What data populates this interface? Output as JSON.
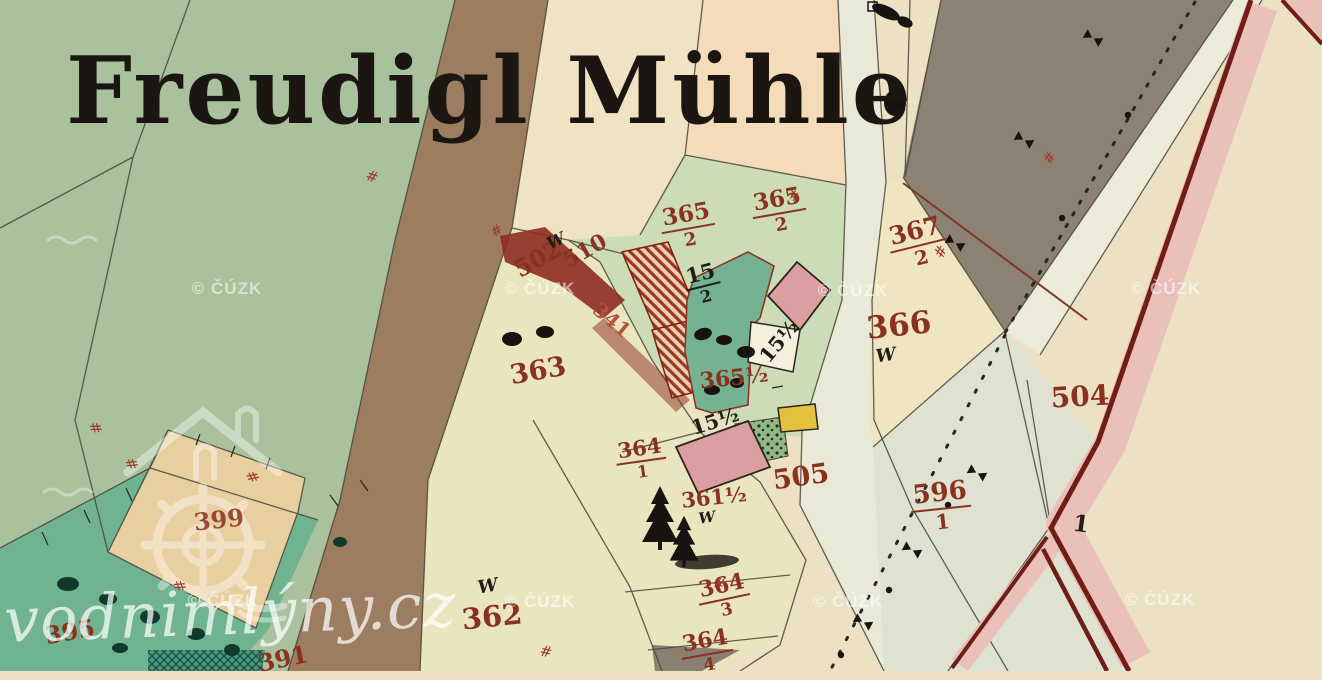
{
  "map": {
    "title": "Freudigl Mühle",
    "watermark": {
      "copyright": "© ČÚZK",
      "site": "vodnimlýny.cz",
      "copyright_positions": [
        {
          "x": 227,
          "y": 289
        },
        {
          "x": 540,
          "y": 289
        },
        {
          "x": 853,
          "y": 291
        },
        {
          "x": 1166,
          "y": 289
        },
        {
          "x": 223,
          "y": 601
        },
        {
          "x": 540,
          "y": 602
        },
        {
          "x": 848,
          "y": 602
        },
        {
          "x": 1160,
          "y": 600
        }
      ]
    },
    "palette": {
      "paper_cream": "#ece1c2",
      "meadow_green": "#a9c19d",
      "garden_teal": "#74b292",
      "garden_teal_low": "#6fb390",
      "road_brown": "#9c7d60",
      "road_pale": "#e9e9d7",
      "pale_area": "#dfe2d1",
      "gray_parcel": "#8d8173",
      "peach": "#f4dcba",
      "light_green": "#ccdcb6",
      "khaki": "#e9e6bf",
      "tan_diamond": "#e8cf9f",
      "pink_building": "#db9fa2",
      "building_hatch_red": "#9e3424",
      "channel_carmine": "#8e2c20",
      "yellow_structure": "#e5c23d",
      "boundary_line": "#4a443b",
      "red_border_line": "#6f1d15",
      "pink_band": "#eac1ba",
      "label_red": "#8a3120",
      "label_black": "#201c17"
    },
    "labels": [
      {
        "name": "parcel-365-2-a",
        "num": "365",
        "den": "2",
        "x": 688,
        "y": 226,
        "rot": -10,
        "size": 23,
        "cls": "red"
      },
      {
        "name": "parcel-365-2-b",
        "num": "365",
        "den": "2",
        "x": 779,
        "y": 211,
        "rot": -10,
        "size": 23,
        "cls": "red"
      },
      {
        "name": "parcel-367-2",
        "num": "367",
        "den": "2",
        "x": 918,
        "y": 243,
        "rot": -14,
        "size": 25,
        "cls": "red"
      },
      {
        "name": "parcel-366",
        "text": "366",
        "x": 899,
        "y": 326,
        "rot": -6,
        "size": 31,
        "cls": "red"
      },
      {
        "name": "parcel-363",
        "text": "363",
        "x": 538,
        "y": 371,
        "rot": -10,
        "size": 27,
        "cls": "red"
      },
      {
        "name": "parcel-362",
        "text": "362",
        "x": 492,
        "y": 617,
        "rot": -6,
        "size": 29,
        "cls": "red"
      },
      {
        "name": "parcel-364-1",
        "num": "364",
        "den": "1",
        "x": 641,
        "y": 459,
        "rot": -8,
        "size": 21,
        "cls": "red"
      },
      {
        "name": "parcel-361-half",
        "text": "361½",
        "x": 714,
        "y": 497,
        "rot": -6,
        "size": 21,
        "cls": "red"
      },
      {
        "name": "parcel-364-3",
        "num": "364",
        "den": "3",
        "x": 724,
        "y": 597,
        "rot": -12,
        "size": 22,
        "cls": "red"
      },
      {
        "name": "parcel-364-4",
        "num": "364",
        "den": "4",
        "x": 707,
        "y": 652,
        "rot": -10,
        "size": 22,
        "cls": "red"
      },
      {
        "name": "parcel-505",
        "text": "505",
        "x": 801,
        "y": 477,
        "rot": -8,
        "size": 27,
        "cls": "red"
      },
      {
        "name": "parcel-504",
        "text": "504",
        "x": 1080,
        "y": 397,
        "rot": -3,
        "size": 28,
        "cls": "red"
      },
      {
        "name": "parcel-596-1",
        "num": "596",
        "den": "1",
        "x": 941,
        "y": 506,
        "rot": -6,
        "size": 26,
        "cls": "red"
      },
      {
        "name": "parcel-502",
        "text": "502",
        "x": 538,
        "y": 259,
        "rot": -29,
        "size": 24,
        "cls": "red"
      },
      {
        "name": "parcel-510",
        "text": "510",
        "x": 585,
        "y": 251,
        "rot": -29,
        "size": 22,
        "cls": "red"
      },
      {
        "name": "channel-label-341",
        "text": "341",
        "x": 612,
        "y": 320,
        "rot": 40,
        "size": 20,
        "cls": "red",
        "color": "#b5523d"
      },
      {
        "name": "parcel-399",
        "text": "399",
        "x": 219,
        "y": 520,
        "rot": -6,
        "size": 24,
        "cls": "red",
        "op": 0.85
      },
      {
        "name": "parcel-395",
        "text": "395",
        "x": 70,
        "y": 632,
        "rot": -10,
        "size": 24,
        "cls": "red"
      },
      {
        "name": "parcel-391",
        "text": "391",
        "x": 283,
        "y": 659,
        "rot": -12,
        "size": 24,
        "cls": "red"
      },
      {
        "name": "parcel-365-half",
        "text": "365½",
        "x": 734,
        "y": 378,
        "rot": -6,
        "size": 22,
        "cls": "red"
      },
      {
        "name": "house-15-2",
        "num": "15",
        "den": "2",
        "x": 703,
        "y": 284,
        "rot": -14,
        "size": 21,
        "cls": "black"
      },
      {
        "name": "house-15-half-a",
        "text": "15½",
        "x": 779,
        "y": 341,
        "rot": -50,
        "size": 20,
        "cls": "black"
      },
      {
        "name": "house-15-half-b",
        "text": "15½",
        "x": 715,
        "y": 421,
        "rot": -18,
        "size": 20,
        "cls": "black"
      },
      {
        "name": "house-1",
        "text": "1",
        "x": 1081,
        "y": 524,
        "rot": 8,
        "size": 23,
        "cls": "black"
      },
      {
        "name": "meadow-mark-w-1",
        "text": "W",
        "x": 556,
        "y": 241,
        "rot": -25,
        "size": 16,
        "cls": "black w"
      },
      {
        "name": "meadow-mark-w-2",
        "text": "W",
        "x": 886,
        "y": 356,
        "rot": -8,
        "size": 18,
        "cls": "black w"
      },
      {
        "name": "meadow-mark-w-3",
        "text": "W",
        "x": 488,
        "y": 587,
        "rot": -10,
        "size": 18,
        "cls": "black w"
      },
      {
        "name": "meadow-mark-w-4",
        "text": "W",
        "x": 707,
        "y": 518,
        "rot": -8,
        "size": 15,
        "cls": "black w"
      },
      {
        "name": "hash-mark-1",
        "text": "#",
        "x": 372,
        "y": 177,
        "rot": 18,
        "size": 15,
        "cls": "hash"
      },
      {
        "name": "hash-mark-2",
        "text": "#",
        "x": 95,
        "y": 428,
        "rot": 75,
        "size": 15,
        "cls": "hash"
      },
      {
        "name": "hash-mark-3",
        "text": "#",
        "x": 131,
        "y": 464,
        "rot": 70,
        "size": 15,
        "cls": "hash"
      },
      {
        "name": "hash-mark-4",
        "text": "#",
        "x": 252,
        "y": 477,
        "rot": 65,
        "size": 15,
        "cls": "hash"
      },
      {
        "name": "hash-mark-5",
        "text": "#",
        "x": 179,
        "y": 586,
        "rot": 72,
        "size": 15,
        "cls": "hash"
      },
      {
        "name": "hash-mark-6",
        "text": "#",
        "x": 546,
        "y": 652,
        "rot": 12,
        "size": 15,
        "cls": "hash"
      },
      {
        "name": "hash-mark-7",
        "text": "#",
        "x": 719,
        "y": 584,
        "rot": 20,
        "size": 15,
        "cls": "hash"
      },
      {
        "name": "hash-mark-8",
        "text": "#",
        "x": 795,
        "y": 196,
        "rot": -58,
        "size": 15,
        "cls": "hash"
      },
      {
        "name": "hash-mark-9",
        "text": "#",
        "x": 941,
        "y": 252,
        "rot": -62,
        "size": 15,
        "cls": "hash"
      },
      {
        "name": "hash-mark-10",
        "text": "#",
        "x": 1050,
        "y": 158,
        "rot": -55,
        "size": 14,
        "cls": "hash"
      },
      {
        "name": "hash-mark-11",
        "text": "#",
        "x": 497,
        "y": 231,
        "rot": -30,
        "size": 14,
        "cls": "hash"
      }
    ]
  }
}
